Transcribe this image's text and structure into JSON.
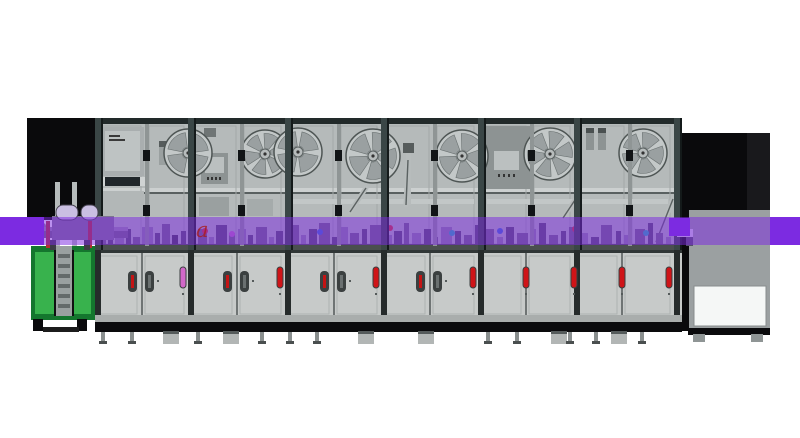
{
  "meta": {
    "description": "Side-view 3D render of an automated electronics assembly line: left green in-feed lift station, six glass-door enclosure modules with tape reels and control screens, lower service cabinets, purple conveyor band crossing the full line, and a dark out-feed tower on the right.",
    "watermark": {
      "t": "a",
      "x": 196,
      "y": 237,
      "size": 21,
      "color": "rgba(168,28,28,0.78)"
    }
  },
  "palette": {
    "violet": "#7c2be1",
    "overlay": "rgba(124,42,225,0.52)",
    "black": "#0a0a0c",
    "frame": "#3a4646",
    "frameDark": "#222a2a",
    "glass": "#b5baba",
    "door": "#c7cac9",
    "gray": "#9ba0a1",
    "white": "#f5f7f6",
    "red": "#cf1418",
    "magenta": "#d168c8",
    "green": "#38b24d",
    "greenDark": "#14762e",
    "steel": "#8f9595",
    "lightSteel": "#c2c7c7"
  },
  "conveyor": {
    "y": 217,
    "h": 28,
    "solidLeft": [
      0,
      44
    ],
    "solidRight": [
      770,
      30
    ],
    "solidJoint": [
      669,
      21
    ]
  },
  "enclosure": {
    "x": 95,
    "y": 118,
    "w": 587,
    "h": 132,
    "topRailH": 6,
    "columns": [
      95,
      188,
      285,
      381,
      478,
      574,
      674
    ],
    "colW": 8,
    "doorSplits": [
      145,
      240,
      337,
      433,
      530,
      628
    ],
    "midRailY": 188,
    "floorY": 244
  },
  "lower": {
    "x": 95,
    "y": 250,
    "w": 72,
    "boundaries": [
      95,
      141,
      188,
      236,
      285,
      333,
      381,
      429,
      478,
      525,
      574,
      621,
      674
    ],
    "columns": [
      95,
      188,
      285,
      381,
      478,
      574,
      674
    ],
    "handles": [
      141,
      236,
      333,
      429
    ],
    "indicators": [
      {
        "x": 180,
        "c": "magenta"
      },
      {
        "x": 277,
        "c": "red"
      },
      {
        "x": 373,
        "c": "red"
      },
      {
        "x": 470,
        "c": "red"
      },
      {
        "x": 523,
        "c": "red"
      },
      {
        "x": 571,
        "c": "red"
      },
      {
        "x": 619,
        "c": "red"
      },
      {
        "x": 666,
        "c": "red"
      }
    ]
  },
  "reels": [
    [
      188,
      153,
      24,
      4
    ],
    [
      265,
      154,
      24,
      6
    ],
    [
      298,
      152,
      24,
      4
    ],
    [
      373,
      156,
      27,
      5
    ],
    [
      462,
      156,
      26,
      5
    ],
    [
      550,
      154,
      26,
      6
    ],
    [
      643,
      153,
      24,
      5
    ]
  ],
  "arms": [
    [
      350,
      212,
      366,
      188
    ],
    [
      406,
      205,
      408,
      160
    ],
    [
      563,
      218,
      575,
      200
    ],
    [
      656,
      242,
      673,
      199
    ]
  ],
  "partsA": [
    [
      "left-tower-body",
      27,
      118,
      68,
      102,
      "#0a0a0c"
    ],
    [
      "left-tower-rail",
      55,
      182,
      5,
      66,
      "#b7bcbc"
    ],
    [
      "left-tower-rail",
      72,
      182,
      5,
      66,
      "#b7bcbc"
    ],
    [
      "right-tower-cabinet",
      688,
      200,
      82,
      130,
      "#9ba0a1"
    ],
    [
      "right-tower-hood",
      683,
      133,
      87,
      77,
      "#0a0a0c"
    ],
    [
      "right-tower-hood-shade",
      747,
      133,
      23,
      77,
      "#19191c"
    ],
    [
      "right-tower-post",
      681,
      133,
      8,
      198,
      "#0a0a0c"
    ],
    [
      "right-tower-window",
      694,
      286,
      72,
      40,
      "#f5f7f6",
      0,
      "#888d8d"
    ]
  ],
  "partsB": [
    [
      "electrical-panel",
      101,
      127,
      43,
      49,
      "#a9aeaf"
    ],
    [
      "electrical-panel-face",
      105,
      131,
      35,
      40,
      "#bec3c3"
    ],
    [
      "panel-label-line",
      109,
      135,
      11,
      2,
      "#3a3a3a"
    ],
    [
      "panel-label-line",
      109,
      139,
      16,
      2,
      "#3a3a3a"
    ],
    [
      "dark-bar",
      100,
      177,
      45,
      9,
      "#20262a"
    ],
    [
      "dark-bar-cap",
      100,
      177,
      5,
      9,
      "#cfd3d3"
    ],
    [
      "dark-bar-cap",
      140,
      177,
      5,
      9,
      "#cfd3d3"
    ],
    [
      "lower-panel",
      101,
      191,
      43,
      25,
      "#b2b7b7"
    ],
    [
      "bracket",
      159,
      141,
      11,
      24,
      "#9aa0a0"
    ],
    [
      "bracket-cap",
      159,
      141,
      11,
      6,
      "#565c5c"
    ],
    [
      "junction-box",
      204,
      128,
      12,
      9,
      "#6f7575"
    ],
    [
      "hmi-monitor",
      201,
      153,
      27,
      31,
      "#8d9393"
    ],
    [
      "hmi-screen",
      205,
      157,
      19,
      16,
      "#bbc0c0"
    ],
    [
      "hmi-button",
      207,
      177,
      2,
      3,
      "#333333"
    ],
    [
      "hmi-button",
      211,
      177,
      2,
      3,
      "#333333"
    ],
    [
      "hmi-button",
      215,
      177,
      2,
      3,
      "#333333"
    ],
    [
      "hmi-button",
      219,
      177,
      2,
      3,
      "#333333"
    ],
    [
      "gear-box",
      199,
      197,
      30,
      19,
      "#9aa0a0"
    ],
    [
      "gear-box",
      247,
      199,
      26,
      17,
      "#a5abab"
    ],
    [
      "pipe-rail",
      293,
      199,
      181,
      5,
      "#c2c7c7"
    ],
    [
      "pipe-rail",
      487,
      199,
      181,
      5,
      "#c2c7c7"
    ],
    [
      "pipe-vertical",
      406,
      150,
      5,
      55,
      "#b7bcbc"
    ],
    [
      "pipe-cap",
      403,
      143,
      11,
      10,
      "#565c5c"
    ],
    [
      "control-cabinet",
      486,
      126,
      45,
      63,
      "#8d9393"
    ],
    [
      "control-screen",
      494,
      151,
      25,
      19,
      "#bbc0c0"
    ],
    [
      "control-button",
      498,
      174,
      2,
      3,
      "#333333"
    ],
    [
      "control-button",
      503,
      174,
      2,
      3,
      "#333333"
    ],
    [
      "control-button",
      508,
      174,
      2,
      3,
      "#333333"
    ],
    [
      "control-button",
      513,
      174,
      2,
      3,
      "#333333"
    ],
    [
      "bracket",
      586,
      128,
      8,
      22,
      "#8d9393"
    ],
    [
      "bracket-cap",
      586,
      128,
      8,
      5,
      "#4a5050"
    ],
    [
      "bracket",
      598,
      128,
      8,
      22,
      "#8d9393"
    ],
    [
      "bracket-cap",
      598,
      128,
      8,
      5,
      "#4a5050"
    ]
  ],
  "partsC": [
    [
      "right-tower-base",
      688,
      328,
      82,
      7,
      "#0a0a0c"
    ],
    [
      "machine-foot",
      693,
      334,
      12,
      8,
      "#8f9595"
    ],
    [
      "machine-foot",
      751,
      334,
      12,
      8,
      "#8f9595"
    ],
    [
      "green-station-frame",
      31,
      246,
      64,
      74,
      "#14762e"
    ],
    [
      "green-station-panel",
      35,
      252,
      19,
      62,
      "#38b24d"
    ],
    [
      "green-station-panel",
      73,
      252,
      18,
      62,
      "#38b24d"
    ],
    [
      "green-station-gap",
      54,
      250,
      20,
      66,
      "#101012"
    ],
    [
      "lift-ladder",
      56,
      246,
      16,
      70,
      "#9aa0a0"
    ],
    [
      "ladder-rung",
      58,
      254,
      12,
      4,
      "#646a6a"
    ],
    [
      "ladder-rung",
      58,
      264,
      12,
      4,
      "#646a6a"
    ],
    [
      "ladder-rung",
      58,
      274,
      12,
      4,
      "#646a6a"
    ],
    [
      "ladder-rung",
      58,
      284,
      12,
      4,
      "#646a6a"
    ],
    [
      "ladder-rung",
      58,
      294,
      12,
      4,
      "#646a6a"
    ],
    [
      "ladder-rung",
      58,
      304,
      12,
      4,
      "#646a6a"
    ],
    [
      "caster-wheel",
      33,
      319,
      10,
      12,
      "#0a0a0c"
    ],
    [
      "caster-wheel",
      77,
      319,
      10,
      12,
      "#0a0a0c"
    ],
    [
      "caster-bar",
      43,
      327,
      36,
      5,
      "#1c1c1c"
    ],
    [
      "feeder-nose",
      28,
      226,
      8,
      8,
      "#54505e"
    ],
    [
      "feeder-tip",
      34,
      223,
      12,
      13,
      "#8a8496",
      3
    ],
    [
      "feeder-bar",
      44,
      227,
      84,
      11,
      "#6f687f"
    ],
    [
      "feeder-bar-top",
      44,
      227,
      84,
      4,
      "#968fa8"
    ],
    [
      "feeder-body",
      52,
      216,
      62,
      24,
      "#7d7690"
    ],
    [
      "feeder-dome",
      56,
      205,
      22,
      15,
      "#cabfe2",
      7,
      "#44404e"
    ],
    [
      "feeder-dome",
      81,
      205,
      17,
      15,
      "#cabfe2",
      7,
      "#44404e"
    ],
    [
      "feeder-post",
      46,
      221,
      4,
      27,
      "#b23030"
    ],
    [
      "feeder-post",
      88,
      221,
      4,
      27,
      "#b23030"
    ],
    [
      "feeder-leg",
      50,
      240,
      6,
      10,
      "#3c3c44"
    ],
    [
      "feeder-leg",
      84,
      240,
      6,
      10,
      "#3c3c44"
    ],
    [
      "conveyor-port",
      677,
      229,
      16,
      8,
      "#ddd8ea"
    ],
    [
      "conveyor-port-slot",
      680,
      231,
      10,
      1,
      "#55505f"
    ],
    [
      "conveyor-port-slot",
      680,
      234,
      10,
      1,
      "#55505f"
    ]
  ],
  "clutterColors": [
    "#6e6880",
    "#55506a",
    "#8b84a0",
    "#413c52"
  ],
  "clutter": [
    [
      99,
      7,
      14,
      0
    ],
    [
      108,
      5,
      20,
      1
    ],
    [
      115,
      9,
      11,
      2
    ],
    [
      126,
      5,
      17,
      1
    ],
    [
      133,
      7,
      9,
      0
    ],
    [
      142,
      11,
      19,
      2
    ],
    [
      155,
      5,
      13,
      1
    ],
    [
      162,
      8,
      22,
      0
    ],
    [
      172,
      6,
      11,
      3
    ],
    [
      181,
      5,
      15,
      1
    ],
    [
      198,
      9,
      17,
      0
    ],
    [
      209,
      5,
      9,
      2
    ],
    [
      216,
      11,
      21,
      1
    ],
    [
      229,
      6,
      13,
      0
    ],
    [
      238,
      8,
      17,
      2
    ],
    [
      248,
      5,
      11,
      1
    ],
    [
      256,
      11,
      19,
      0
    ],
    [
      269,
      5,
      9,
      2
    ],
    [
      276,
      7,
      15,
      1
    ],
    [
      290,
      9,
      21,
      0
    ],
    [
      301,
      5,
      11,
      2
    ],
    [
      309,
      8,
      17,
      1
    ],
    [
      319,
      11,
      23,
      0
    ],
    [
      332,
      5,
      9,
      1
    ],
    [
      341,
      7,
      19,
      2
    ],
    [
      350,
      9,
      13,
      0
    ],
    [
      362,
      5,
      17,
      1
    ],
    [
      370,
      11,
      21,
      0
    ],
    [
      386,
      6,
      11,
      2
    ],
    [
      394,
      8,
      15,
      1
    ],
    [
      404,
      5,
      23,
      0
    ],
    [
      412,
      9,
      13,
      2
    ],
    [
      424,
      7,
      17,
      1
    ],
    [
      434,
      4,
      9,
      0
    ],
    [
      441,
      11,
      19,
      2
    ],
    [
      455,
      6,
      15,
      1
    ],
    [
      464,
      8,
      11,
      0
    ],
    [
      475,
      5,
      21,
      1
    ],
    [
      484,
      10,
      17,
      0
    ],
    [
      497,
      6,
      9,
      2
    ],
    [
      506,
      8,
      19,
      1
    ],
    [
      517,
      11,
      13,
      0
    ],
    [
      531,
      5,
      17,
      2
    ],
    [
      539,
      7,
      23,
      1
    ],
    [
      549,
      9,
      11,
      0
    ],
    [
      561,
      5,
      15,
      1
    ],
    [
      569,
      10,
      19,
      0
    ],
    [
      582,
      6,
      13,
      2
    ],
    [
      591,
      8,
      9,
      1
    ],
    [
      601,
      11,
      21,
      0
    ],
    [
      616,
      5,
      15,
      1
    ],
    [
      624,
      8,
      11,
      2
    ],
    [
      635,
      10,
      17,
      0
    ],
    [
      648,
      5,
      23,
      1
    ],
    [
      656,
      7,
      13,
      0
    ],
    [
      666,
      5,
      9,
      2
    ],
    [
      686,
      7,
      9,
      1
    ]
  ],
  "dots": [
    [
      205,
      231,
      "#d23535"
    ],
    [
      232,
      234,
      "#c06ac0"
    ],
    [
      320,
      232,
      "#3a6cd2"
    ],
    [
      390,
      228,
      "#d23535"
    ],
    [
      452,
      233,
      "#22b0b8"
    ],
    [
      500,
      231,
      "#3a6cd2"
    ],
    [
      575,
      229,
      "#d23535"
    ],
    [
      646,
      233,
      "#22b0b8"
    ]
  ],
  "feetBoxes": [
    163,
    223,
    358,
    418,
    551,
    611
  ],
  "feetSmall": [
    101,
    130,
    196,
    260,
    288,
    315,
    486,
    515,
    568,
    594,
    640
  ]
}
